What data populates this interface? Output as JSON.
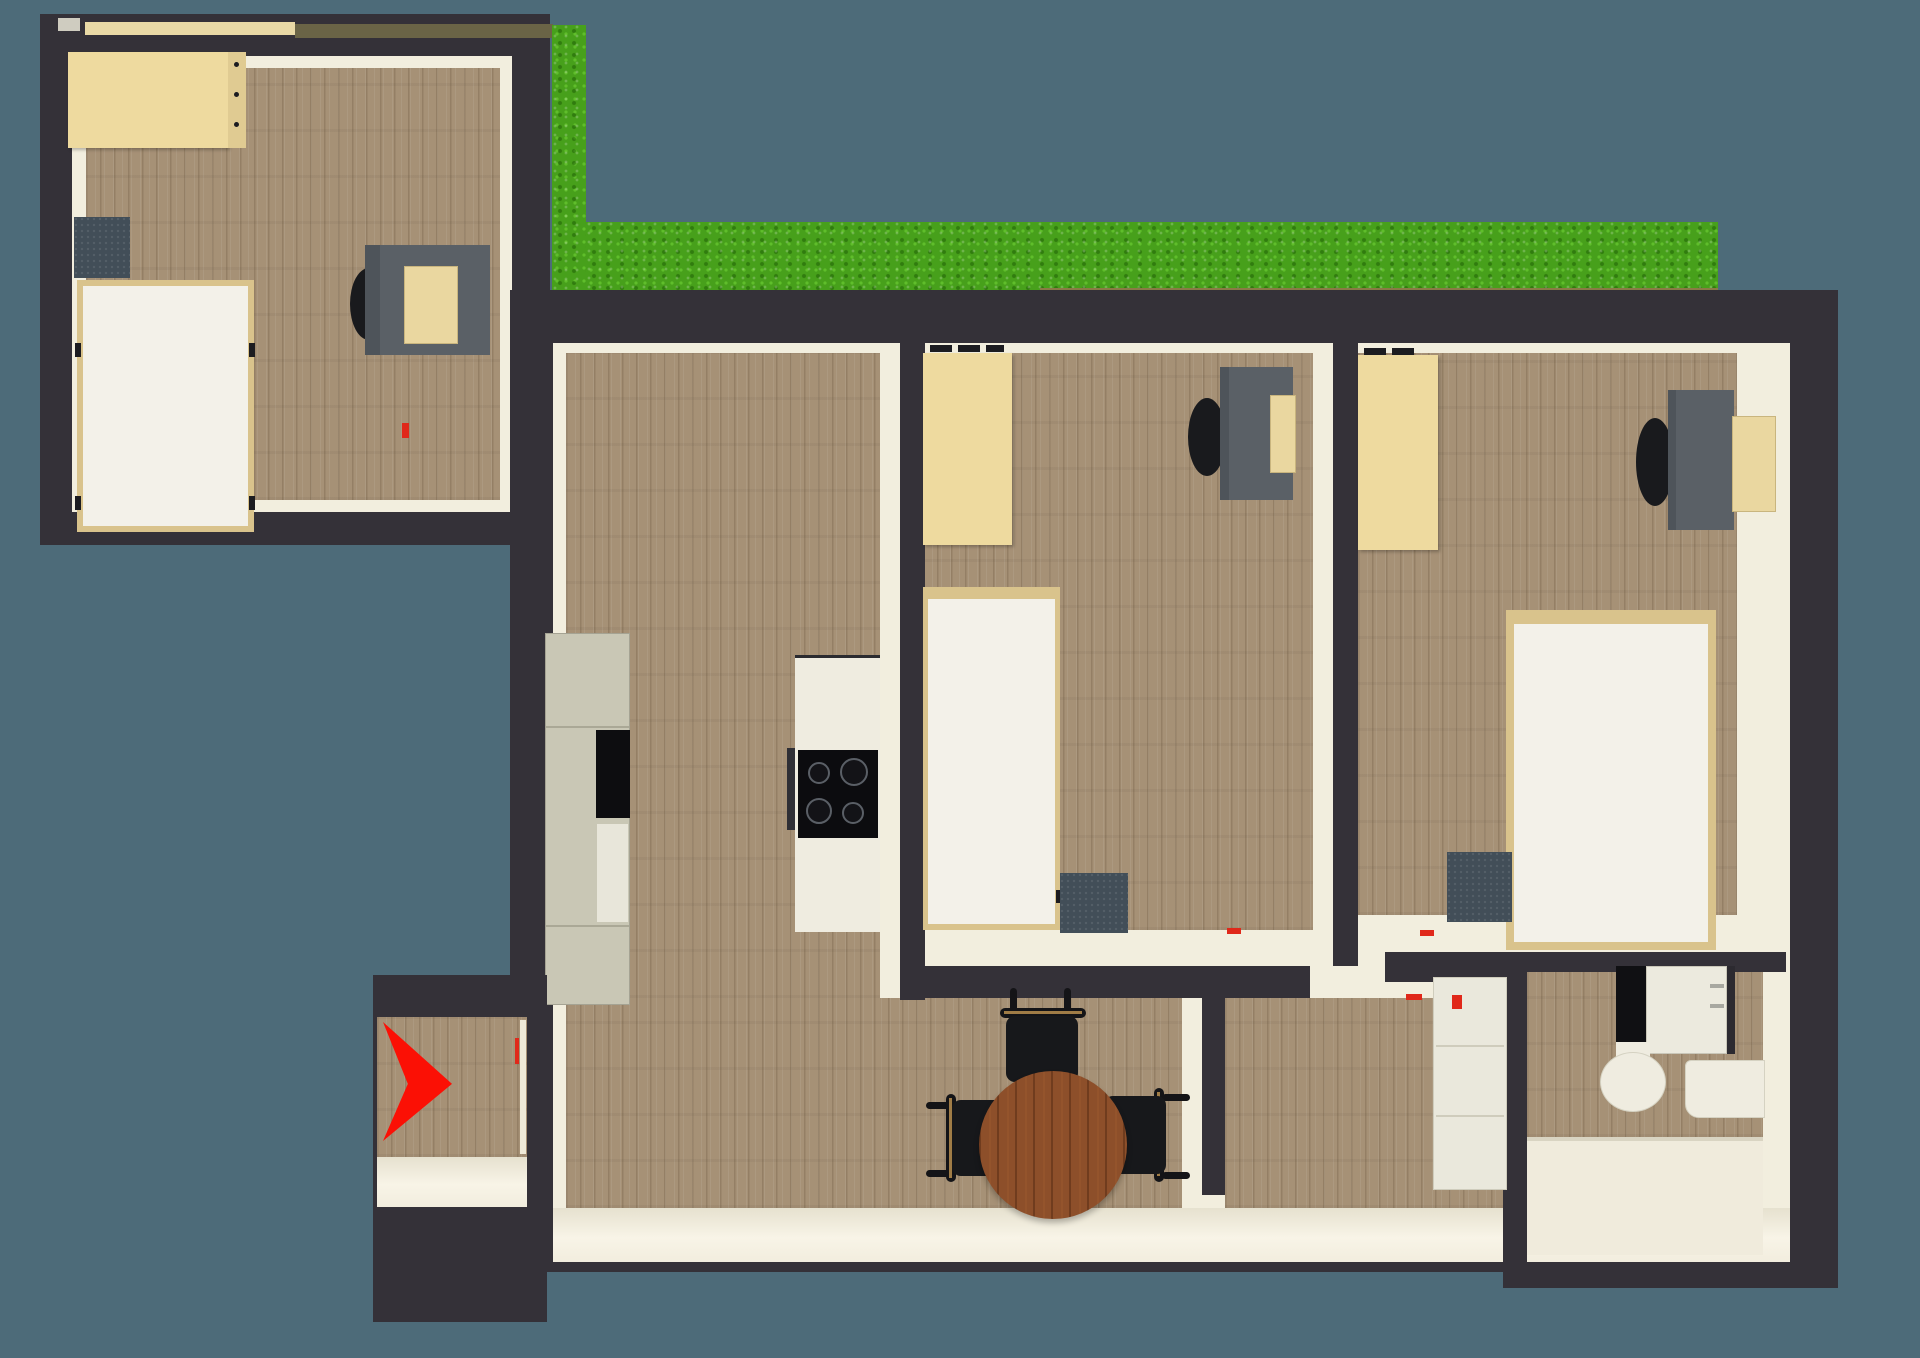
{
  "scene": {
    "type": "3d-top-down-floor-plan",
    "description": "Rendered bird's-eye floor plan of an apartment with three bedrooms, living room with kitchen and dining table, hallway, bathroom, entrance arrow and grass terrace",
    "background_color": "#4d6b79",
    "wall_color": "#343138",
    "wood_floor_color": "#a69176",
    "floor_trim_color": "#f2eede",
    "grass_color": "#47a01b",
    "entrance_arrow_color": "#fb1005"
  },
  "palette": {
    "furniture_beige": "#eeda9f",
    "bed_frame_beige": "#d9c38c",
    "bed_linen_white": "#f3f1e9",
    "desk_gray": "#5a6066",
    "nightstand_slate": "#424e58",
    "chair_black": "#17181b",
    "dining_table_brown": "#8d4f2a",
    "kitchen_cabinet_sage": "#c9c7b5",
    "appliance_black": "#0d0d10",
    "bathroom_fixture_white": "#efece0"
  },
  "rooms": [
    {
      "id": "bedroom-top-left",
      "label": "Bedroom 1 (detached top-left block)",
      "furniture_labels": [
        "Wardrobe",
        "Nightstand",
        "Single bed",
        "Desk",
        "Desk chair",
        "Computer"
      ]
    },
    {
      "id": "living-kitchen",
      "label": "Living room with kitchen and dining area",
      "furniture_labels": [
        "Tall cabinet with oven and fridge",
        "Kitchen counter with cooktop (4 burners)",
        "Round dining table",
        "Three dining chairs"
      ]
    },
    {
      "id": "bedroom-middle",
      "label": "Bedroom 2 (middle)",
      "furniture_labels": [
        "Wardrobe",
        "Single bed",
        "Nightstand",
        "Desk",
        "Desk chair",
        "Computer"
      ]
    },
    {
      "id": "bedroom-right",
      "label": "Bedroom 3 (right)",
      "furniture_labels": [
        "Wardrobe",
        "Double bed",
        "Nightstand",
        "Desk",
        "Desk chair",
        "Wall shelf"
      ]
    },
    {
      "id": "hallway",
      "label": "Hallway",
      "furniture_labels": [
        "Dresser"
      ]
    },
    {
      "id": "bathroom",
      "label": "Bathroom",
      "furniture_labels": [
        "Washing machine",
        "Cabinet",
        "Toilet",
        "Sink",
        "Bathtub"
      ]
    },
    {
      "id": "entrance",
      "label": "Entrance alcove with red direction arrow",
      "furniture_labels": [
        "Entrance arrow"
      ]
    },
    {
      "id": "garden",
      "label": "Grass terrace strip (L-shaped)",
      "furniture_labels": []
    }
  ]
}
